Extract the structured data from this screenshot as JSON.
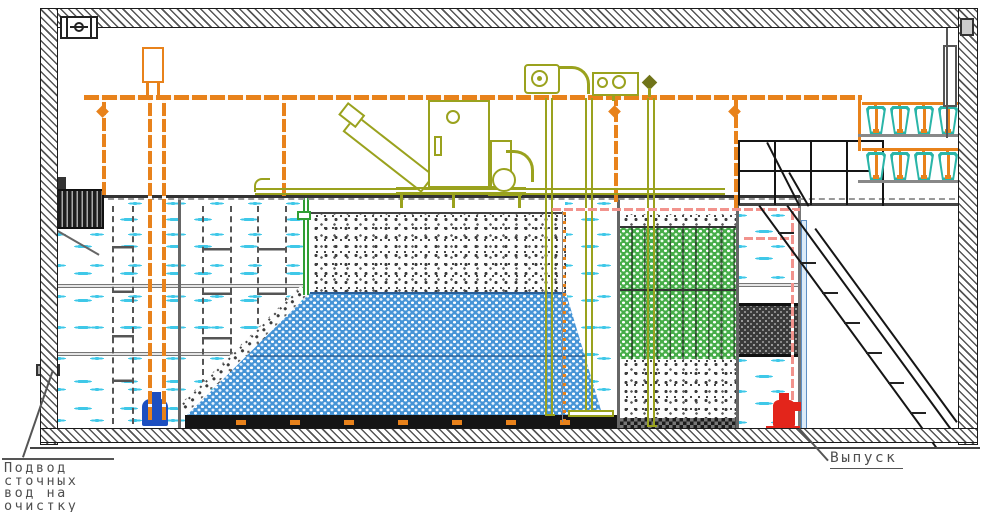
{
  "diagram": {
    "labels": {
      "inlet_lines": [
        "Подвод",
        "сточных",
        "вод на",
        "очистку"
      ],
      "outlet": "Выпуск"
    },
    "colors": {
      "pipe_orange": "#e8821b",
      "equipment_olive": "#9aa21e",
      "water_dash_cyan": "#3fc8e8",
      "media_blue": "#4694d6",
      "media_green": "#46ad49",
      "pipe_pink": "#f2938d",
      "outlet_pipe_blue": "#5d8fc4",
      "pump_red": "#e3251b",
      "pump_blue": "#1d4fc0",
      "vessel_teal": "#2ab5a8",
      "wall_hatch_gray": "#555555"
    }
  }
}
